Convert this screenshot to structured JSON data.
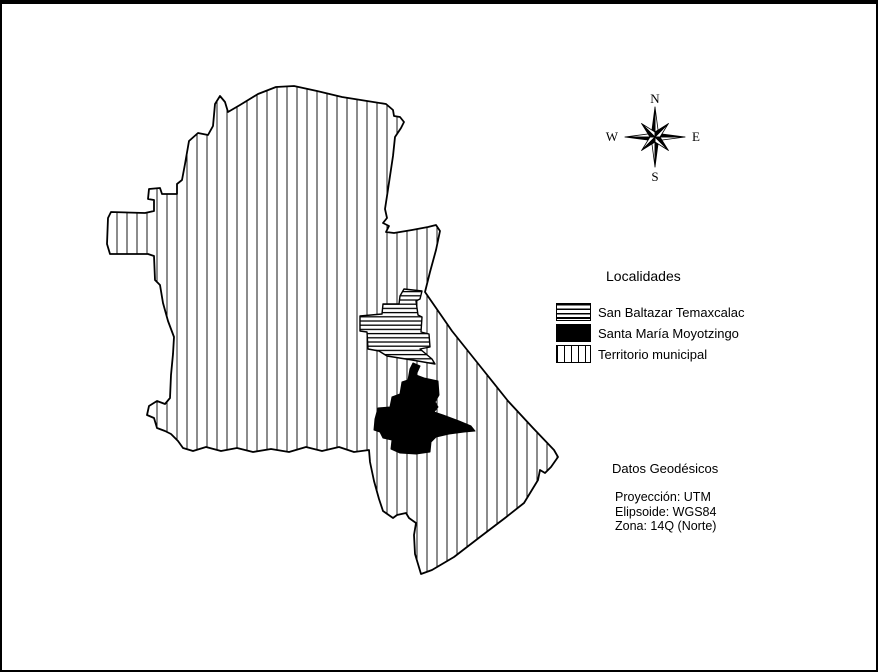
{
  "map": {
    "regions": [
      {
        "name": "Territorio municipal",
        "pattern": "vertical-stripes"
      },
      {
        "name": "San Baltazar Temaxcalac",
        "pattern": "horizontal-stripes"
      },
      {
        "name": "Santa María Moyotzingo",
        "pattern": "solid-black"
      }
    ]
  },
  "compass": {
    "north": "N",
    "east": "E",
    "south": "S",
    "west": "W"
  },
  "legend": {
    "title": "Localidades",
    "items": [
      {
        "label": "San Baltazar Temaxcalac",
        "swatch": "horizontal-stripes"
      },
      {
        "label": "Santa María Moyotzingo",
        "swatch": "solid-black"
      },
      {
        "label": "Territorio municipal",
        "swatch": "vertical-stripes"
      }
    ]
  },
  "geodesic": {
    "title": "Datos Geodésicos",
    "lines": [
      "Proyección: UTM",
      "Elipsoide: WGS84",
      "Zona: 14Q (Norte)"
    ]
  },
  "colors": {
    "ink": "#000000",
    "background": "#ffffff"
  }
}
